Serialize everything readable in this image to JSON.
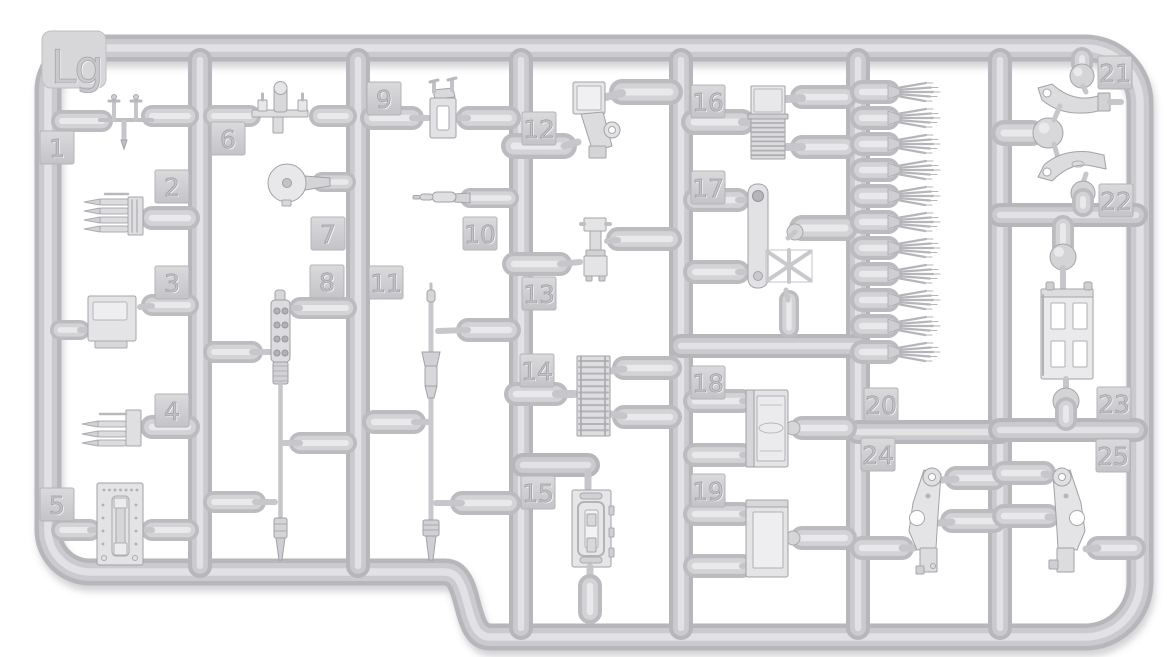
{
  "image": {
    "kind": "plastic-model-kit-sprue-photo",
    "background": "#ffffff"
  },
  "sprue": {
    "label": "Lg",
    "part_count": 25,
    "colors": {
      "tube_base": "#b7b7bb",
      "tube_mid": "#cbcbcf",
      "tube_highlight": "#e2e2e5",
      "gate_base": "#bcbcc0",
      "tag_fill_top": "#dadadd",
      "tag_fill_bottom": "#c4c4c8",
      "part_fill": "#e2e2e5",
      "part_edge": "#a6a6aa"
    }
  },
  "parts": [
    {
      "number": "1",
      "name": "small-linkage"
    },
    {
      "number": "2",
      "name": "ammo-clip-4-rounds"
    },
    {
      "number": "3",
      "name": "receiver-box"
    },
    {
      "number": "4",
      "name": "ammo-clip-3-rounds"
    },
    {
      "number": "5",
      "name": "riveted-plate"
    },
    {
      "number": "6",
      "name": "mount-bracket"
    },
    {
      "number": "7",
      "name": "disc-with-hole"
    },
    {
      "number": "8",
      "name": "machine-gun-barrel"
    },
    {
      "number": "9",
      "name": "frame-bracket"
    },
    {
      "number": "10",
      "name": "small-cylinder"
    },
    {
      "number": "11",
      "name": "long-rod"
    },
    {
      "number": "12",
      "name": "angled-bracket"
    },
    {
      "number": "13",
      "name": "clamp-bracket"
    },
    {
      "number": "14",
      "name": "ammo-belt"
    },
    {
      "number": "15",
      "name": "hatch-door"
    },
    {
      "number": "16",
      "name": "ammo-box-with-belt"
    },
    {
      "number": "17",
      "name": "truss-bracket"
    },
    {
      "number": "18",
      "name": "ammo-box-embossed"
    },
    {
      "number": "19",
      "name": "ammo-box-plain"
    },
    {
      "number": "20",
      "name": "bullet-rows",
      "rows": 11
    },
    {
      "number": "21",
      "name": "curved-arm-upper"
    },
    {
      "number": "22",
      "name": "curved-arm-lower"
    },
    {
      "number": "23",
      "name": "perforated-box"
    },
    {
      "number": "24",
      "name": "mount-plate-left"
    },
    {
      "number": "25",
      "name": "mount-plate-right"
    }
  ]
}
